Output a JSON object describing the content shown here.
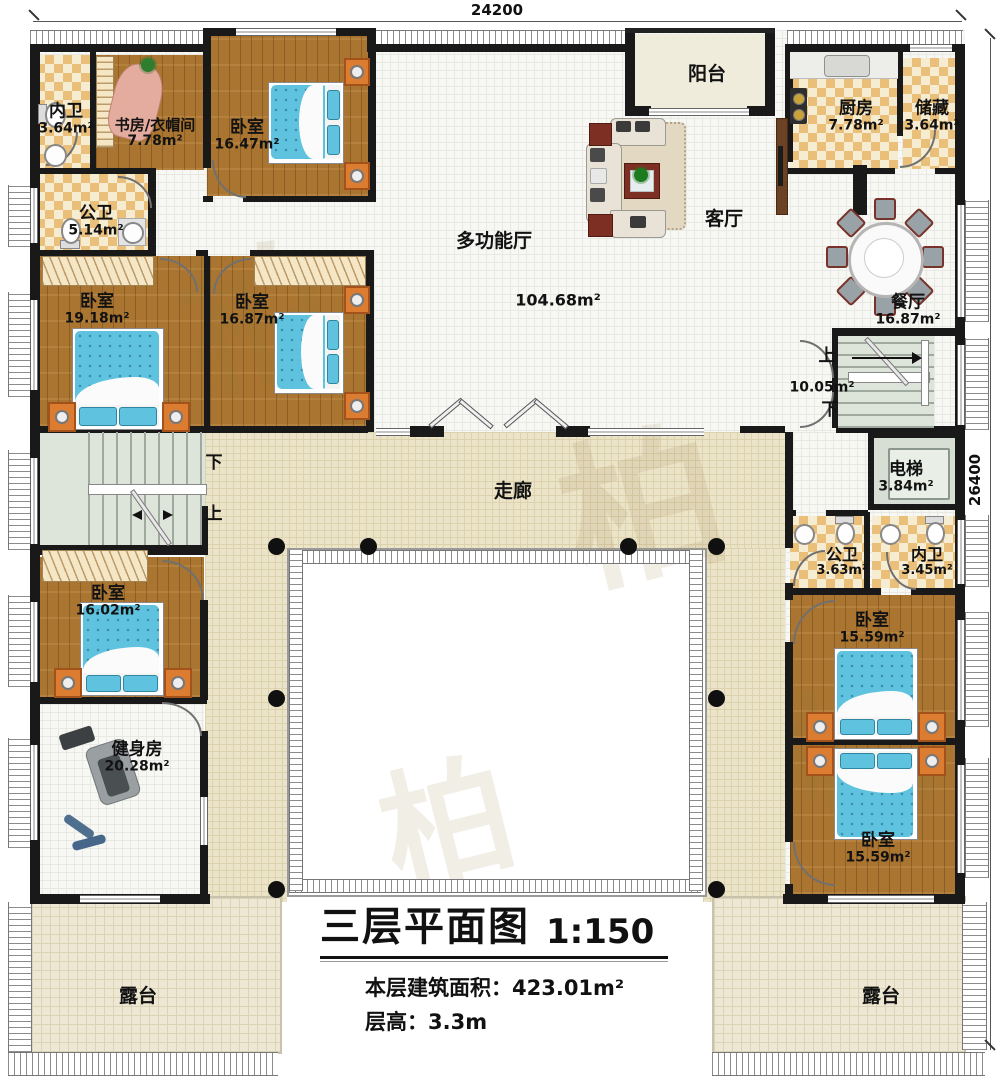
{
  "title_block": {
    "title": "三层平面图",
    "scale": "1:150",
    "area_label": "本层建筑面积：",
    "area_value": "423.01m²",
    "floor_height_label": "层高：",
    "floor_height_value": "3.3m"
  },
  "dimensions": {
    "top": "24200",
    "right": "26400"
  },
  "rooms": {
    "neiwei_top": {
      "name": "内卫",
      "area": "3.64m²"
    },
    "study": {
      "name": "书房/衣帽间",
      "area": "7.78m²"
    },
    "bedroom_1647": {
      "name": "卧室",
      "area": "16.47m²"
    },
    "gongwei_514": {
      "name": "公卫",
      "area": "5.14m²"
    },
    "bedroom_1918": {
      "name": "卧室",
      "area": "19.18m²"
    },
    "bedroom_1687_left": {
      "name": "卧室",
      "area": "16.87m²"
    },
    "hall": {
      "name": "多功能厅",
      "area": "104.68m²"
    },
    "living": {
      "name": "客厅"
    },
    "balcony": {
      "name": "阳台"
    },
    "kitchen": {
      "name": "厨房",
      "area": "7.78m²"
    },
    "storage": {
      "name": "储藏",
      "area": "3.64m²"
    },
    "dining": {
      "name": "餐厅",
      "area": "16.87m²"
    },
    "stairs_right": {
      "up": "上",
      "down": "下",
      "area": "10.05m²"
    },
    "elevator": {
      "name": "电梯",
      "area": "3.84m²"
    },
    "gongwei_363": {
      "name": "公卫",
      "area": "3.63m²"
    },
    "neiwei_345": {
      "name": "内卫",
      "area": "3.45m²"
    },
    "bedroom_1559_upper": {
      "name": "卧室",
      "area": "15.59m²"
    },
    "bedroom_1559_lower": {
      "name": "卧室",
      "area": "15.59m²"
    },
    "corridor": {
      "name": "走廊"
    },
    "stairs_left": {
      "down": "下",
      "up": "上"
    },
    "bedroom_1602": {
      "name": "卧室",
      "area": "16.02m²"
    },
    "gym": {
      "name": "健身房",
      "area": "20.28m²"
    },
    "terrace_left": {
      "name": "露台"
    },
    "terrace_right": {
      "name": "露台"
    }
  },
  "watermark": {
    "glyph": "柏"
  }
}
